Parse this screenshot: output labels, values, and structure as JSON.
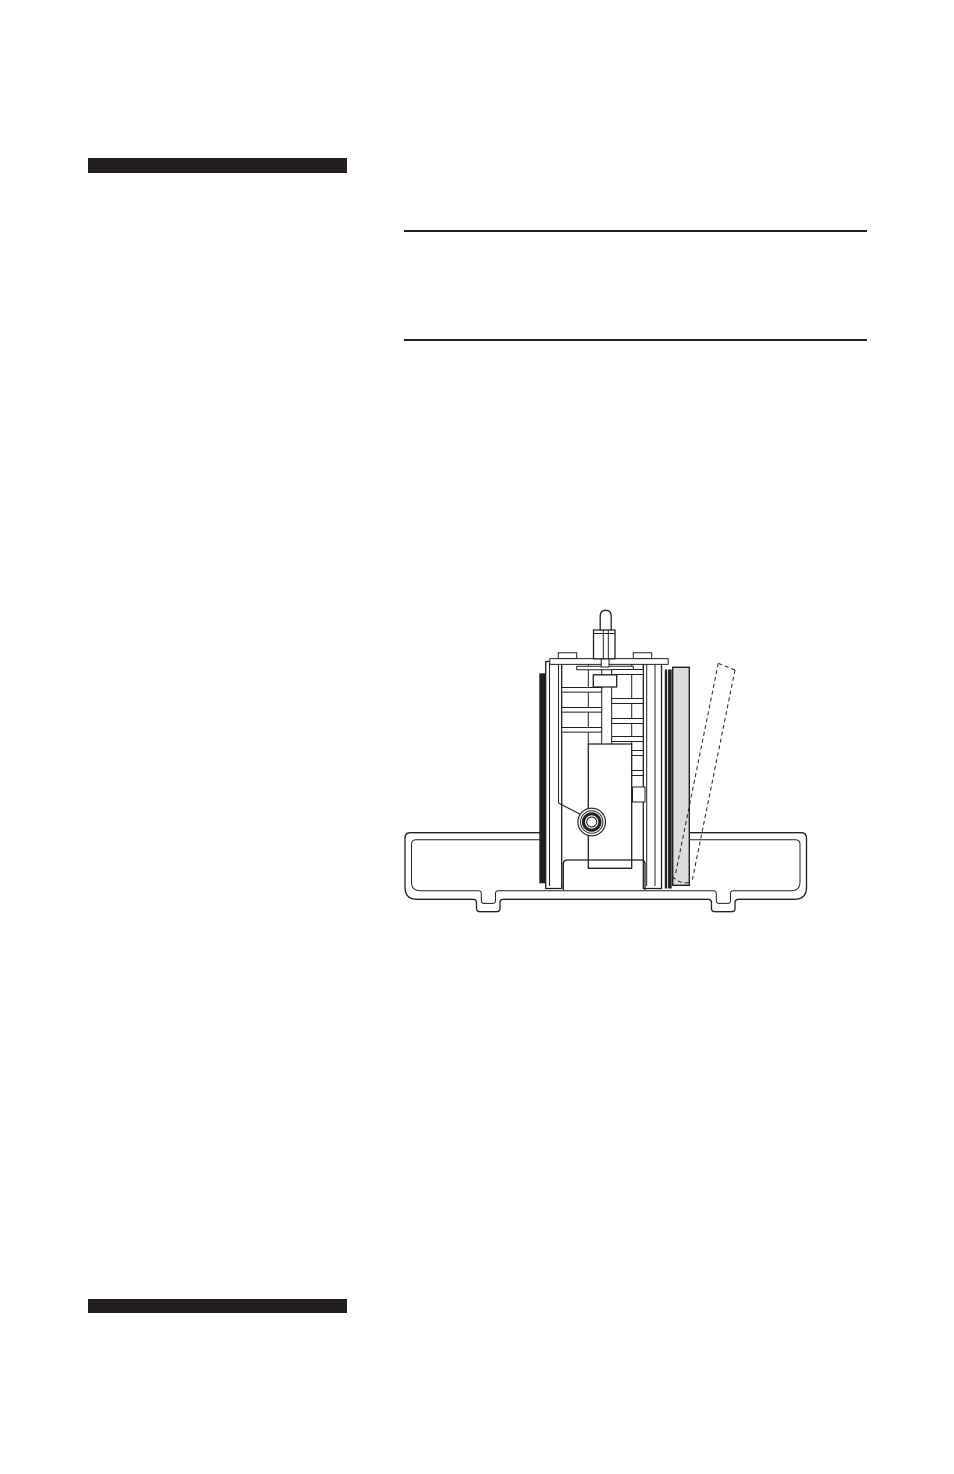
{
  "page": {
    "background_color": "#ffffff",
    "ink_color": "#231f20"
  },
  "decorations": {
    "top_section_bar": {
      "color": "#231f20"
    },
    "bottom_section_bar": {
      "color": "#231f20"
    },
    "text_rules": {
      "color": "#231f20",
      "count": 2
    }
  },
  "figure": {
    "kind": "technical-line-drawing",
    "description": "Side cross-section of a mechanism assembly seated in a mounting tray; a shaded side panel is shown installed, with a dashed outline indicating the panel tilted outward.",
    "colors": {
      "line": "#231f20",
      "panel_fill": "#dcdcdc",
      "bar_fill": "#231f20",
      "background": "#ffffff"
    }
  }
}
